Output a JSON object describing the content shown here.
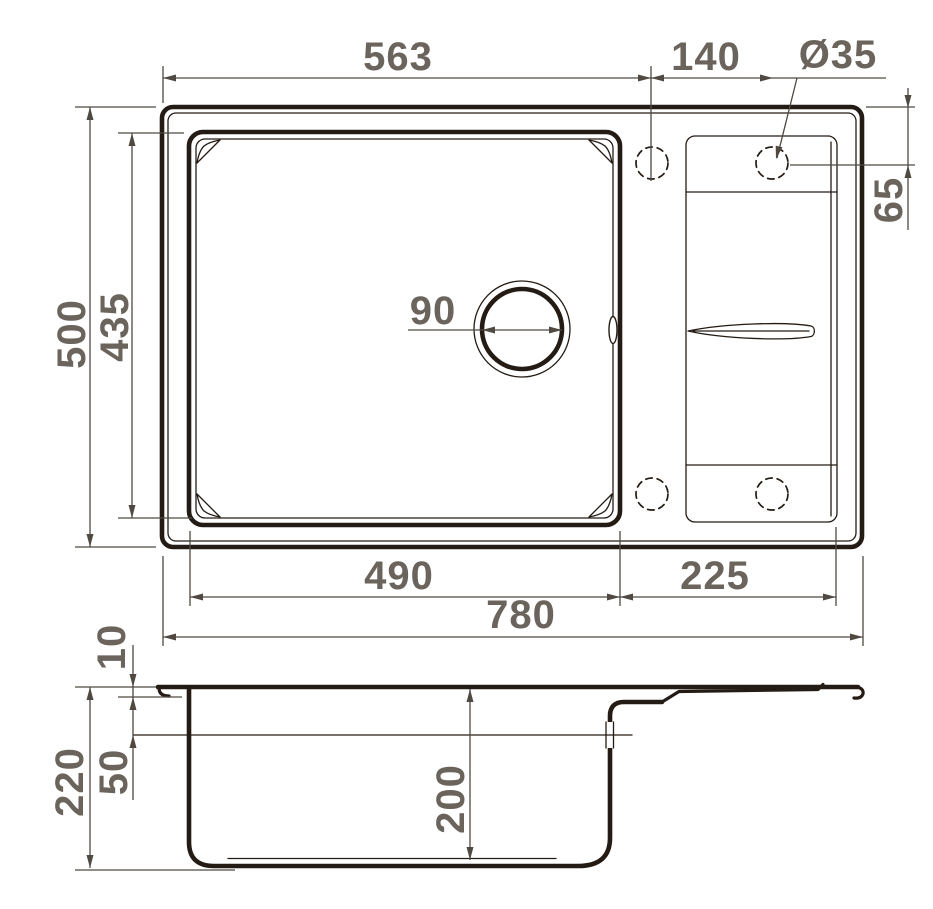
{
  "colors": {
    "line": "#241c14",
    "dim": "#4f4942",
    "text": "#6b645d",
    "background": "#ffffff"
  },
  "dims": {
    "bowl_span": "563",
    "hole_spacing": "140",
    "hole_diameter": "Ø35",
    "hole_inset": "65",
    "overall_depth": "500",
    "bowl_depth_outer": "435",
    "drain_diameter": "90",
    "bowl_width": "490",
    "wing_width": "225",
    "overall_width": "780",
    "rim_height": "10",
    "overflow_drop": "50",
    "overall_height": "220",
    "bowl_inner_depth": "200"
  }
}
